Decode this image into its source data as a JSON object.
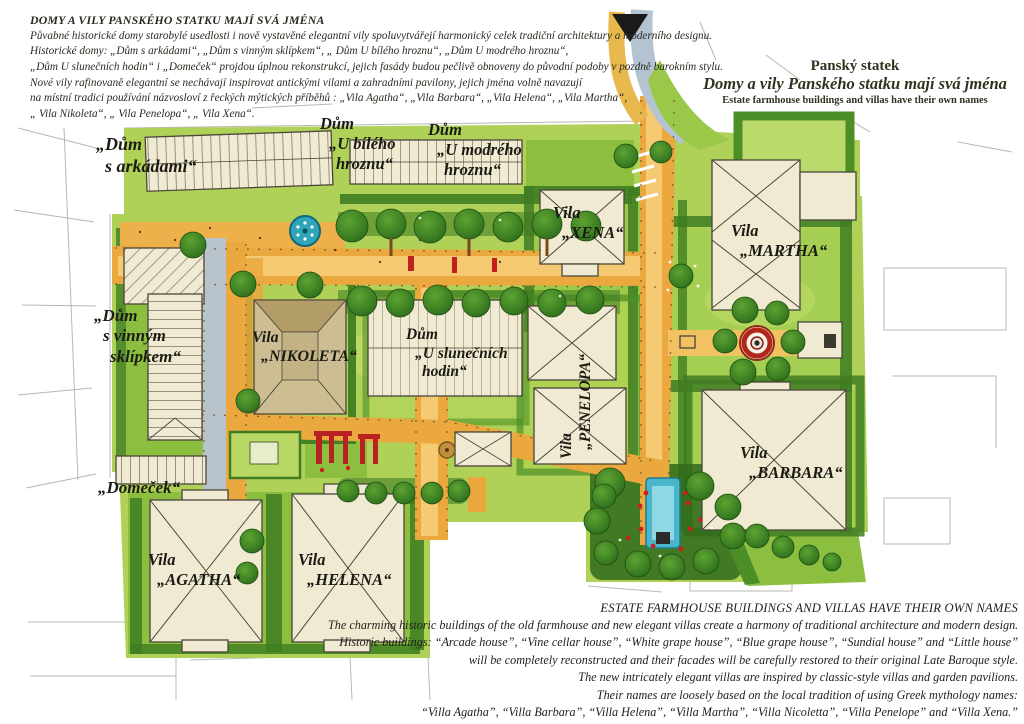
{
  "header_left": {
    "title": "DOMY A VILY PANSKÉHO STATKU MAJÍ SVÁ JMÉNA",
    "lines": [
      "Půvabné historické domy starobylé usedlosti i nově vystavěné elegantní vily spoluvytvářejí harmonický celek tradiční architektury a moderního designu.",
      "Historické domy: „Dům s arkádami“, „Dům s vinným sklípkem“, „ Dům U bílého hroznu“, „Dům U modrého hroznu“,",
      "„Dům U slunečních hodin“ i „Domeček“  projdou úplnou rekonstrukcí, jejich fasády budou pečlivě obnoveny do původní podoby v pozdně barokním stylu.",
      "Nové vily rafinovaně elegantní se nechávají inspirovat antickými vilami a zahradními pavilony,  jejich jména volně navazují",
      "na místní tradici používání názvosloví z řeckých mýtických příběhů : „Vila Agatha“, „Vila Barbara“, „Vila Helena“, „Vila Martha“,",
      "„ Vila Nikoleta“, „ Vila Penelopa“, „ Vila Xena“."
    ]
  },
  "header_right": {
    "line1": "Panský statek",
    "line2": "Domy a vily Panského statku mají svá jména",
    "line3": "Estate farmhouse buildings and villas have their own names"
  },
  "footer_right": {
    "title": "ESTATE FARMHOUSE BUILDINGS AND VILLAS HAVE THEIR OWN NAMES",
    "lines": [
      "The charming historic buildings of the old farmhouse and new elegant villas create a harmony of traditional architecture and modern design.",
      "Historic buildings: “Arcade house”, “Vine cellar house”, “White grape house”, “Blue grape house”, “Sundial house” and “Little house”",
      "will be completely reconstructed and their facades will be carefully restored to their original Late Baroque style.",
      "The new intricately elegant villas are inspired by classic-style villas and garden pavilions.",
      "Their names are loosely based on the local tradition of using Greek mythology names:",
      "“Villa Agatha”, “Villa Barbara”, “Villa Helena”, “Villa Martha”, “Villa Nicoletta”, “Villa Penelope” and “Villa Xena.”"
    ]
  },
  "map_labels": {
    "arcade": {
      "l1": "„Dům",
      "l2": "s arkádami“"
    },
    "white_grape": {
      "l1": "Dům",
      "l2": "„U bílého",
      "l3": "hroznu“"
    },
    "blue_grape": {
      "l1": "Dům",
      "l2": "„U modrého",
      "l3": "hroznu“"
    },
    "xena": {
      "l1": "Vila",
      "l2": "„XENA“"
    },
    "martha": {
      "l1": "Vila",
      "l2": "„MARTHA“"
    },
    "vine_cellar": {
      "l1": "„Dům",
      "l2": "s vinným",
      "l3": "sklípkem“"
    },
    "nikoleta": {
      "l1": "Vila",
      "l2": "„NIKOLETA“"
    },
    "sundial": {
      "l1": "Dům",
      "l2": "„U slunečních",
      "l3": "hodin“"
    },
    "penelopa": {
      "l1": "Vila",
      "l2": "„PENELOPA“"
    },
    "barbara": {
      "l1": "Vila",
      "l2": "„BARBARA“"
    },
    "domecek": {
      "l1": "„Domeček“"
    },
    "agatha": {
      "l1": "Vila",
      "l2": "„AGATHA“"
    },
    "helena": {
      "l1": "Vila",
      "l2": "„HELENA“"
    }
  },
  "palette": {
    "lawn_light": "#b0d158",
    "lawn_mid": "#8cbf3f",
    "hedge_dark": "#3f7d22",
    "tree_dark": "#2b661a",
    "road_orange": "#eaa83e",
    "road_yellow": "#f6ca72",
    "road_grey": "#b3c3d2",
    "building_cream": "#f1ead3",
    "water_blue": "#49b6cc",
    "fountain_red": "#b3261a",
    "ink": "#1b1b15"
  }
}
